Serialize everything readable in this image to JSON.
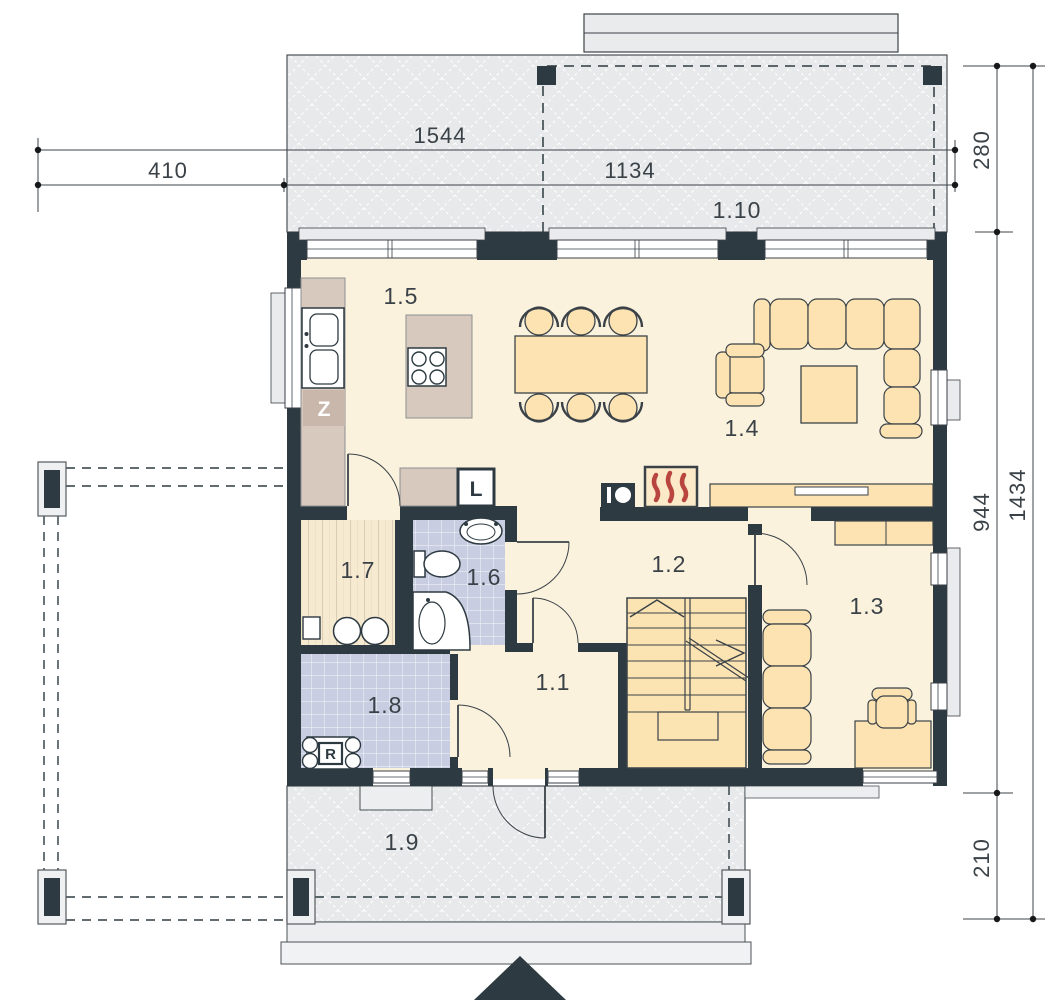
{
  "rooms": {
    "hall": {
      "label": "1.1"
    },
    "stair_hall": {
      "label": "1.2"
    },
    "room": {
      "label": "1.3"
    },
    "living_room": {
      "label": "1.4"
    },
    "kitchen": {
      "label": "1.5"
    },
    "bathroom": {
      "label": "1.6"
    },
    "pantry": {
      "label": "1.7"
    },
    "utility_room": {
      "label": "1.8"
    },
    "front_terrace": {
      "label": "1.9"
    },
    "rear_terrace": {
      "label": "1.10"
    }
  },
  "dimensions": {
    "total_width": "1544",
    "left_extension": "410",
    "main_width": "1134",
    "rear_terrace_depth": "280",
    "house_depth": "944",
    "total_depth": "1434",
    "front_terrace_depth": "210"
  },
  "appliances": {
    "dishwasher": "Z",
    "fridge": "L",
    "boiler": "R"
  },
  "colors": {
    "wall": "#2d3a41",
    "floor": "#fbf2dd",
    "furniture": "#fce3b1",
    "counter": "#d7c9be",
    "tile": "#c9cde1",
    "wood": "#f6ead1",
    "terrace": "#e7e9ea",
    "flame": "#b9453f",
    "line": "#3a4248"
  }
}
